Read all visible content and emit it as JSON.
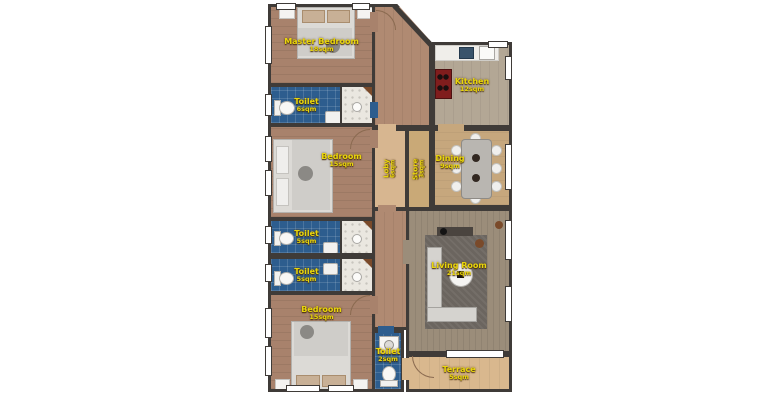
{
  "plan": {
    "title": "apartment-floor-plan",
    "rooms": {
      "master_bedroom": {
        "name": "Master Bedroom",
        "area": "18sqm"
      },
      "toilet_master": {
        "name": "Toilet",
        "area": "6sqm"
      },
      "kitchen": {
        "name": "Kitchen",
        "area": "12sqm"
      },
      "bedroom_mid": {
        "name": "Bedroom",
        "area": "15sqm"
      },
      "lobby": {
        "name": "Loby",
        "area": "6sqm"
      },
      "store": {
        "name": "Store",
        "area": "3sqm"
      },
      "dining": {
        "name": "Dining",
        "area": "9sqm"
      },
      "toilet_a": {
        "name": "Toilet",
        "area": "5sqm"
      },
      "toilet_b": {
        "name": "Toilet",
        "area": "5sqm"
      },
      "bedroom_bottom": {
        "name": "Bedroom",
        "area": "15sqm"
      },
      "living_room": {
        "name": "Living Room",
        "area": "21sqm"
      },
      "toilet_small": {
        "name": "Toilet",
        "area": "2sqm"
      },
      "terrace": {
        "name": "Terrace",
        "area": "5sqm"
      }
    },
    "colors": {
      "wall": "#3f3b38",
      "bedroom_floor": "#a8826c",
      "toilet_floor": "#2d5d8e",
      "kitchen_floor": "#b3a795",
      "dining_floor": "#c6a77d",
      "lobby_floor": "#d7b690",
      "living_floor": "#9b8d7a",
      "terrace_floor": "#d9b88e",
      "label_text": "#e9d60b",
      "background": "#ffffff"
    }
  }
}
